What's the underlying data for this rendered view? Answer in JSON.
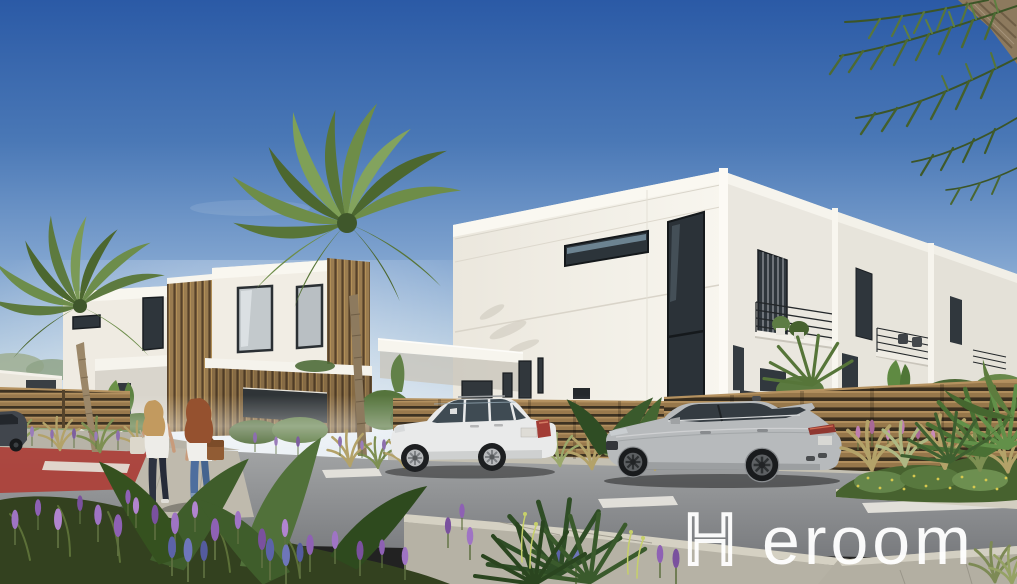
{
  "meta": {
    "width": 1017,
    "height": 584,
    "kind": "architectural-exterior-rendering"
  },
  "watermark": {
    "h": "H",
    "rest": "eroom",
    "full_text": "Heroom",
    "color": "#ffffff",
    "style": "first letter outlined, remaining letters solid white, wide letter spacing"
  },
  "scene": {
    "description": "Daytime rendering of a modern white two-story townhouse complex with wood-slat accents, palm trees, landscaped street, two parked SUVs and two women walking away",
    "sky": {
      "top": "#2b5aa6",
      "mid": "#7fa3cf",
      "horizon": "#dfe8ef"
    },
    "buildings": {
      "label": "white modern townhouses",
      "wall_bright": "#f6f3ec",
      "wall_shaded": "#e7e4db",
      "wood_slat": "#9a7c50",
      "glass_dark": "#2c343a",
      "glass_light": "#c3c9cc",
      "garage_door": "#2f3437",
      "balcony_railing": "#23272a"
    },
    "street": {
      "asphalt": "#8b8d8f",
      "sidewalk": "#b9b5a9",
      "curb": "#d5d1c3",
      "red_lane": "#ad3f37",
      "lane_marking": "#e8e6e0"
    },
    "vehicles": [
      {
        "label": "white SUV parked facing left",
        "color": "#e9eaea"
      },
      {
        "label": "silver SUV parked facing left",
        "color": "#b7babc"
      },
      {
        "label": "dark car at far left edge",
        "color": "#41464d"
      }
    ],
    "people": [
      {
        "label": "blonde woman walking away, white top, dark jeans, light tote bag"
      },
      {
        "label": "red-haired woman walking away, white top, blue jeans, brown shoulder bag"
      }
    ],
    "vegetation": {
      "palm_green": "#5d7a3f",
      "palm_dark": "#47622f",
      "lavender_pink": "#b06ec0",
      "lavender_deep": "#7d4b92",
      "blue_spike": "#5c63a8",
      "grass_tan": "#b3a269",
      "shrub_green": "#4e6b33",
      "yellow_flowers": "#d6c84e"
    }
  }
}
